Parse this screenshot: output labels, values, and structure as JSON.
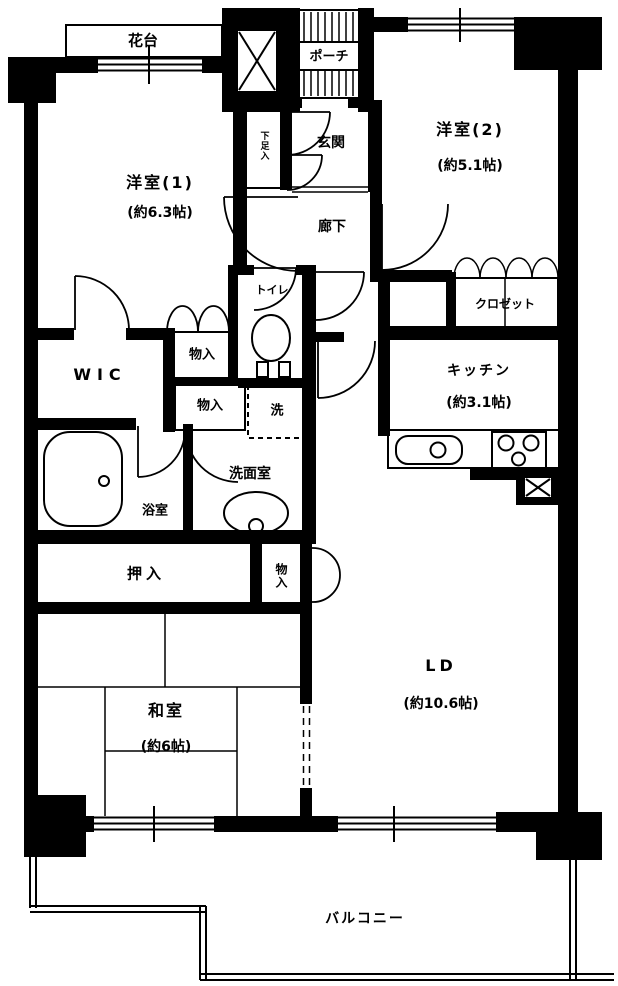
{
  "plan_type": "floorplan",
  "colors": {
    "wall": "#000000",
    "background": "#ffffff",
    "line": "#000000"
  },
  "rooms": {
    "hanadai": {
      "label": "花台"
    },
    "porch": {
      "label": "ポーチ"
    },
    "shoe_box": {
      "label": "下足入"
    },
    "genkan": {
      "label": "玄関"
    },
    "hallway": {
      "label": "廊下"
    },
    "western_room_1": {
      "label": "洋室(1)",
      "size": "(約6.3帖)"
    },
    "western_room_2": {
      "label": "洋室(2)",
      "size": "(約5.1帖)"
    },
    "closet": {
      "label": "クロゼット"
    },
    "kitchen": {
      "label": "キッチン",
      "size": "(約3.1帖)"
    },
    "toilet": {
      "label": "トイレ"
    },
    "storage_1": {
      "label": "物入"
    },
    "storage_2": {
      "label": "物入"
    },
    "washer": {
      "label": "洗"
    },
    "wic": {
      "label": "WIC"
    },
    "bathroom": {
      "label": "浴室"
    },
    "washroom": {
      "label": "洗面室"
    },
    "oshiire": {
      "label": "押入"
    },
    "storage_3": {
      "label": "物入"
    },
    "japanese_room": {
      "label": "和室",
      "size": "(約6帖)"
    },
    "living_dining": {
      "label": "LD",
      "size": "(約10.6帖)"
    },
    "balcony": {
      "label": "バルコニー"
    }
  },
  "icons": {
    "elevator_shaft": "x-box-icon",
    "pipe_shaft": "x-box-icon",
    "bathtub": "bathtub-icon",
    "toilet_bowl": "toilet-icon",
    "washbasin": "washbasin-icon",
    "kitchen_sink": "sink-icon",
    "stove": "stove-icon",
    "washer_pan": "dashed-washer-pan-icon"
  }
}
